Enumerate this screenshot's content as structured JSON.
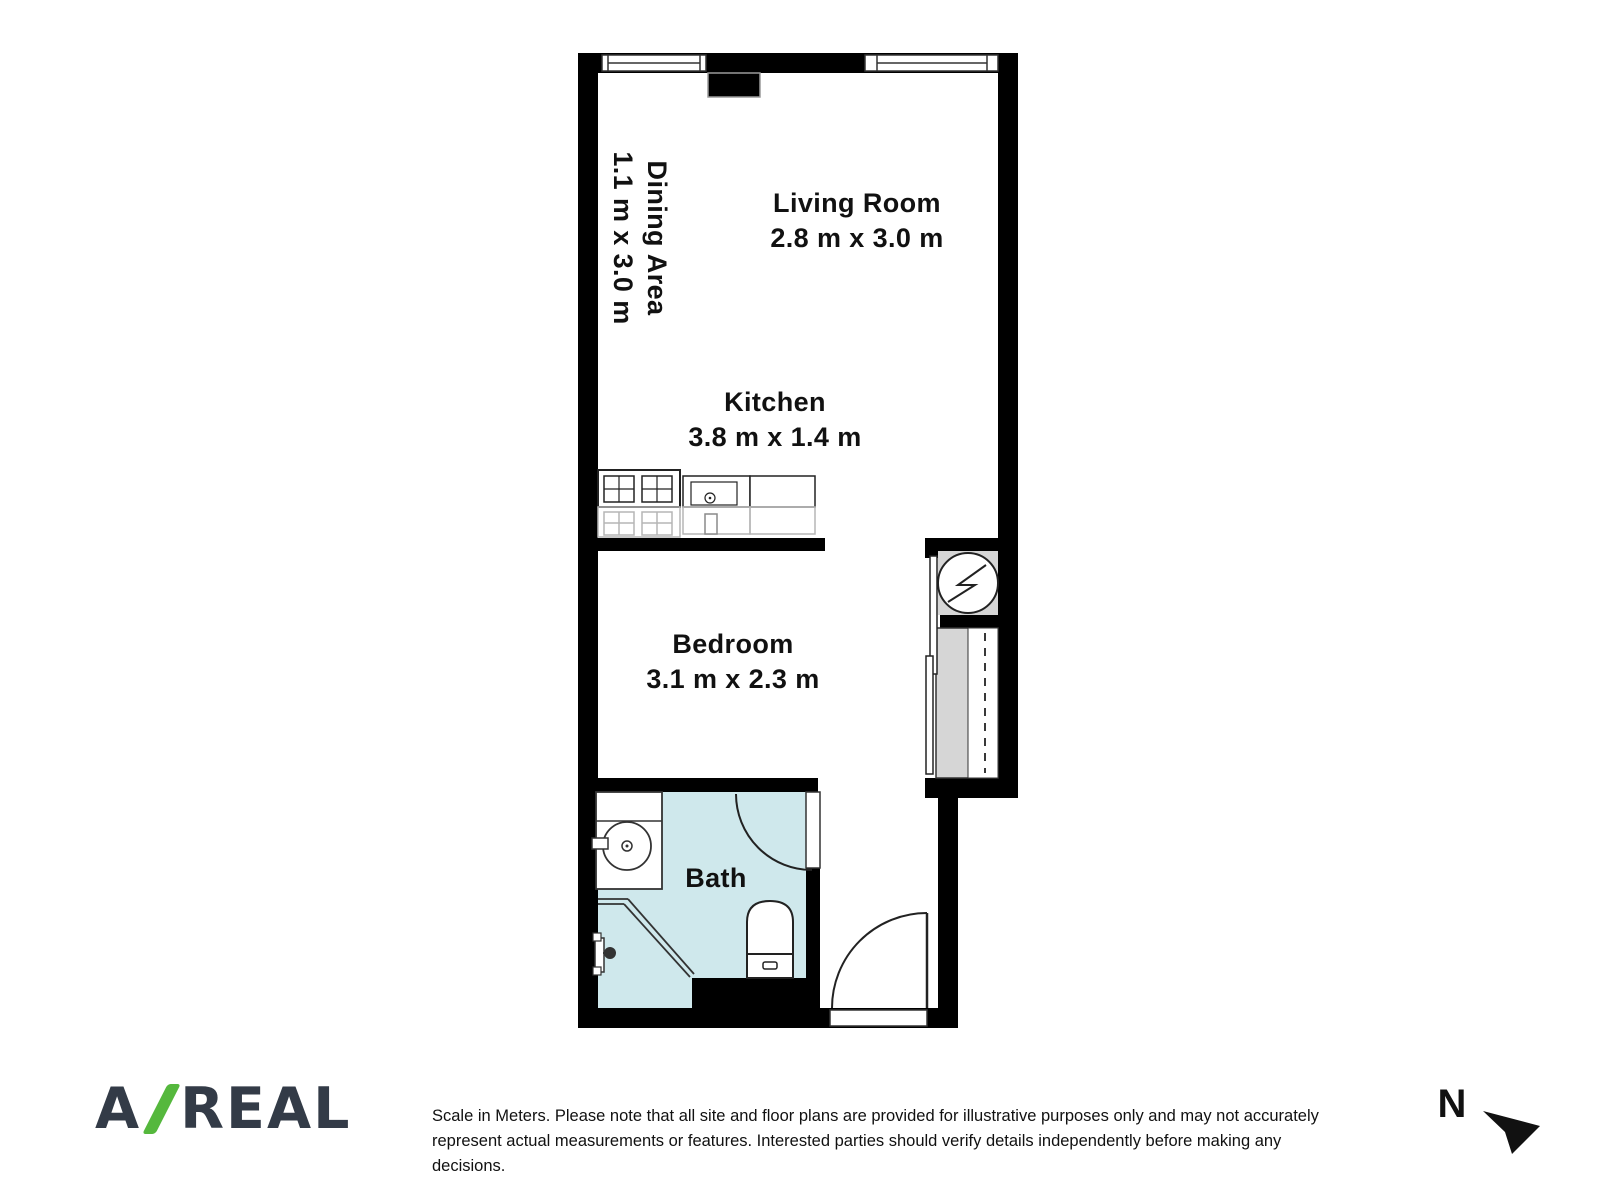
{
  "floorplan": {
    "rooms": [
      {
        "name": "Dining Area",
        "dimensions": "1.1 m x 3.0 m"
      },
      {
        "name": "Living Room",
        "dimensions": "2.8 m x 3.0 m"
      },
      {
        "name": "Kitchen",
        "dimensions": "3.8 m x 1.4 m"
      },
      {
        "name": "Bedroom",
        "dimensions": "3.1 m x 2.3 m"
      },
      {
        "name": "Bath",
        "dimensions": ""
      }
    ],
    "fixture_icons": [
      "window-icon",
      "wall-protrusion",
      "stove-cooktop-icon",
      "kitchen-sink-icon",
      "counter-icon",
      "washer-icon",
      "wardrobe-closet",
      "sliding-door",
      "vanity-sink-icon",
      "corner-shower-icon",
      "toilet-icon",
      "bath-door-swing",
      "entry-door-swing"
    ],
    "colors": {
      "walls": "#000000",
      "bath_floor": "#cfe8ec",
      "closet_fill": "#d6d6d6",
      "stroke": "#222222"
    }
  },
  "footer": {
    "logo": {
      "letter_a": "A",
      "word": "REAL",
      "slash_color": "#55b83d",
      "text_color": "#333b47"
    },
    "disclaimer_line1": "Scale in Meters. Please note that all site and floor plans are provided for illustrative purposes only and may not accurately",
    "disclaimer_line2": "represent actual measurements or features. Interested parties should verify details independently before making any decisions.",
    "compass": {
      "label": "N"
    }
  }
}
